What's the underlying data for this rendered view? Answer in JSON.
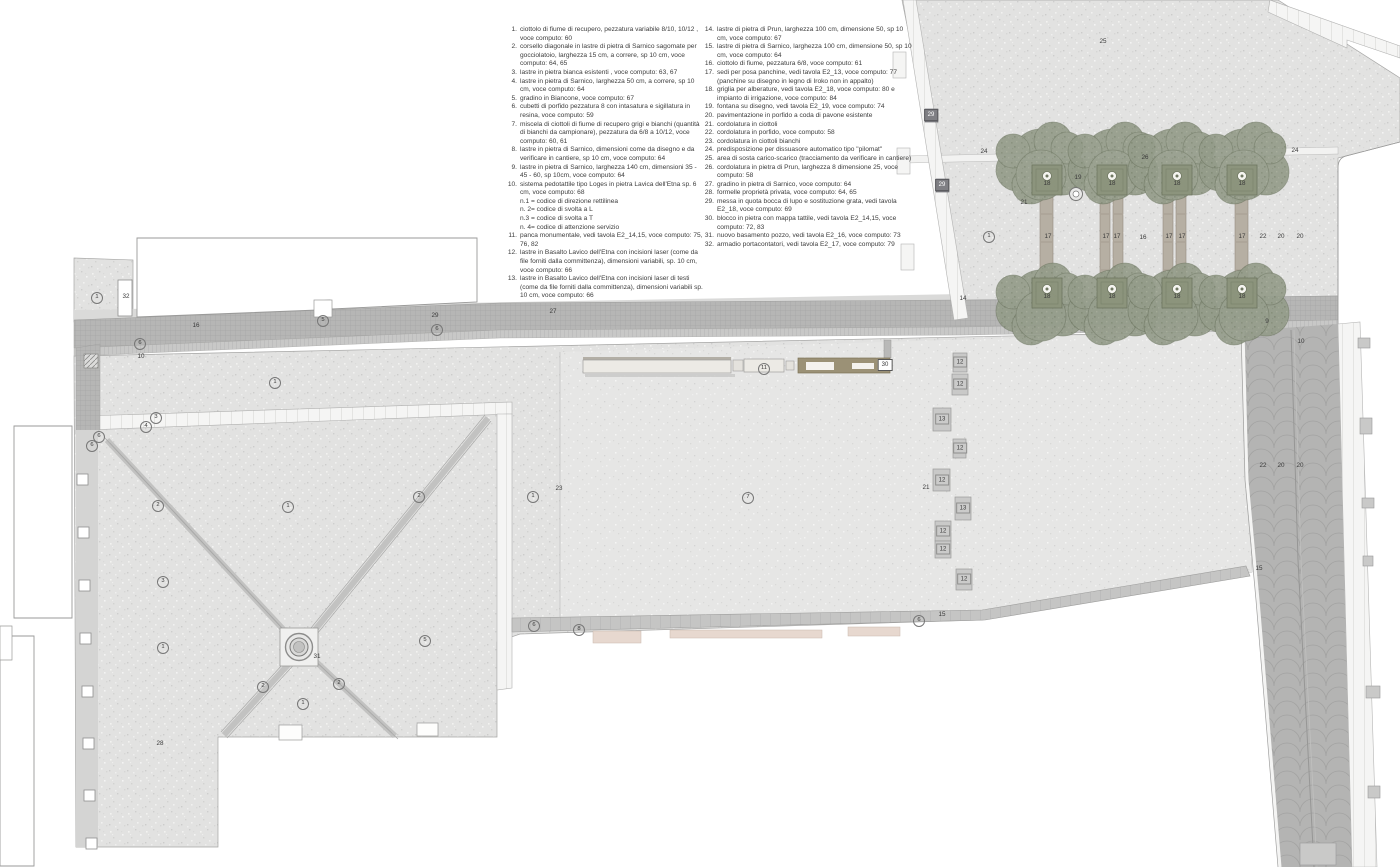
{
  "colors": {
    "paving": "#e2e2e1",
    "paving_light": "#e6e6e5",
    "road_cubetti": "#b6b6b5",
    "porphyry_street": "#b4b4b3",
    "white_slab": "#f5f5f4",
    "tree_canopy": "#949c8a",
    "bench": "#eceae5",
    "tactile_block": "#9b9176",
    "step_pink": "#e7d8cf"
  },
  "legend": {
    "col1": [
      {
        "n": "1.",
        "t": "ciottolo di fiume di recupero, pezzatura variabile 8/10, 10/12 , voce computo: 60"
      },
      {
        "n": "2.",
        "t": "corsello diagonale in lastre di pietra di Sarnico sagomate per gocciolatoio, larghezza 15 cm, a correre, sp 10 cm, voce computo: 64, 65"
      },
      {
        "n": "3.",
        "t": "lastre in pietra bianca esistenti , voce computo: 63, 67"
      },
      {
        "n": "4.",
        "t": "lastre in pietra di Sarnico, larghezza 50 cm, a correre, sp 10 cm, voce computo: 64"
      },
      {
        "n": "5.",
        "t": "gradino in Biancone, voce computo: 67"
      },
      {
        "n": "6.",
        "t": "cubetti di porfido pezzatura 8 con intasatura e sigillatura in resina, voce computo: 59"
      },
      {
        "n": "7.",
        "t": "miscela di ciottoli di fiume di recupero grigi e bianchi (quantità di bianchi da campionare), pezzatura da 6/8 a 10/12, voce computo: 60, 61"
      },
      {
        "n": "8.",
        "t": "lastre in pietra di Sarnico, dimensioni come da disegno e da verificare in cantiere, sp 10 cm, voce computo: 64"
      },
      {
        "n": "9.",
        "t": "lastre in pietra di Sarnico, larghezza 140 cm, dimensioni 35 - 45 - 60, sp 10cm, voce computo: 64"
      },
      {
        "n": "10.",
        "t": "sistema pedotattile tipo Loges in pietra Lavica dell'Etna sp. 6 cm, voce computo: 68"
      },
      {
        "n": "",
        "t": "n.1 = codice di direzione rettilinea"
      },
      {
        "n": "",
        "t": "n. 2= codice di svolta a L"
      },
      {
        "n": "",
        "t": "n.3 = codice di svolta a T"
      },
      {
        "n": "",
        "t": "n. 4= codice di attenzione servizio"
      },
      {
        "n": "11.",
        "t": "panca monumentale, vedi tavola E2_14,15, voce computo: 75, 76, 82"
      },
      {
        "n": "12.",
        "t": "lastre in Basalto Lavico dell'Etna con incisioni laser (come da file forniti dalla committenza), dimensioni variabili, sp. 10 cm, voce computo: 66"
      },
      {
        "n": "13.",
        "t": "lastre in Basalto Lavico dell'Etna con incisioni laser di testi (come da file forniti dalla committenza), dimensioni variabili sp. 10 cm, voce computo: 66"
      }
    ],
    "col2": [
      {
        "n": "14.",
        "t": "lastre di pietra di Prun, larghezza 100 cm, dimensione 50, sp 10 cm, voce computo: 67"
      },
      {
        "n": "15.",
        "t": "lastre di pietra di Sarnico, larghezza 100 cm, dimensione 50, sp 10 cm, voce computo: 64"
      },
      {
        "n": "16.",
        "t": "ciottolo di fiume, pezzatura 6/8, voce computo: 61"
      },
      {
        "n": "17.",
        "t": "sedi per posa panchine, vedi tavola E2_13, voce computo: 77 (panchine su disegno in legno di Iroko non in appalto)"
      },
      {
        "n": "18.",
        "t": "griglia per alberature, vedi tavola E2_18, voce computo: 80 e impianto di irrigazione, voce computo: 84"
      },
      {
        "n": "19.",
        "t": "fontana su disegno, vedi tavola E2_19, voce computo: 74"
      },
      {
        "n": "20.",
        "t": "pavimentazione in porfido a coda di pavone esistente"
      },
      {
        "n": "21.",
        "t": "cordolatura in ciottoli"
      },
      {
        "n": "22.",
        "t": "cordolatura in porfido, voce computo: 58"
      },
      {
        "n": "23.",
        "t": "cordolatura in ciottoli bianchi"
      },
      {
        "n": "24.",
        "t": "predisposizione per dissuasore automatico tipo \"pilomat\""
      },
      {
        "n": "25.",
        "t": "area di sosta carico-scarico (tracciamento da verificare in cantiere)"
      },
      {
        "n": "26.",
        "t": "cordolatura in pietra di Prun, larghezza 8 dimensione 25, voce computo: 58"
      },
      {
        "n": "27.",
        "t": "gradino in pietra di Sarnico, voce computo: 64"
      },
      {
        "n": "28.",
        "t": "formelle proprietà privata, voce computo: 64, 65"
      },
      {
        "n": "29.",
        "t": "messa in quota bocca di lupo e sostituzione grata, vedi tavola E2_18, voce computo: 69"
      },
      {
        "n": "30.",
        "t": "blocco in pietra con mappa tattile, vedi tavola E2_14,15, voce computo: 72, 83"
      },
      {
        "n": "31.",
        "t": "nuovo basamento pozzo, vedi tavola E2_16, voce computo: 73"
      },
      {
        "n": "32.",
        "t": "armadio portacontatori, vedi tavola E2_17, voce computo: 79"
      }
    ]
  },
  "plan": {
    "annotations": [
      {
        "n": "1",
        "x": 97,
        "y": 298,
        "k": "c"
      },
      {
        "n": "32",
        "x": 126,
        "y": 297,
        "k": "p"
      },
      {
        "n": "16",
        "x": 196,
        "y": 326,
        "k": "p"
      },
      {
        "n": "6",
        "x": 140,
        "y": 344,
        "k": "c"
      },
      {
        "n": "10",
        "x": 141,
        "y": 357,
        "k": "p"
      },
      {
        "n": "5",
        "x": 323,
        "y": 321,
        "k": "c"
      },
      {
        "n": "29",
        "x": 435,
        "y": 316,
        "k": "p"
      },
      {
        "n": "6",
        "x": 437,
        "y": 330,
        "k": "c"
      },
      {
        "n": "27",
        "x": 553,
        "y": 312,
        "k": "p"
      },
      {
        "n": "1",
        "x": 275,
        "y": 383,
        "k": "c"
      },
      {
        "n": "3",
        "x": 156,
        "y": 418,
        "k": "c"
      },
      {
        "n": "4",
        "x": 146,
        "y": 427,
        "k": "c"
      },
      {
        "n": "6",
        "x": 99,
        "y": 437,
        "k": "c"
      },
      {
        "n": "6",
        "x": 92,
        "y": 446,
        "k": "c"
      },
      {
        "n": "2",
        "x": 158,
        "y": 506,
        "k": "c"
      },
      {
        "n": "1",
        "x": 288,
        "y": 507,
        "k": "c"
      },
      {
        "n": "2",
        "x": 419,
        "y": 497,
        "k": "c"
      },
      {
        "n": "3",
        "x": 163,
        "y": 582,
        "k": "c"
      },
      {
        "n": "1",
        "x": 163,
        "y": 648,
        "k": "c"
      },
      {
        "n": "5",
        "x": 425,
        "y": 641,
        "k": "c"
      },
      {
        "n": "31",
        "x": 317,
        "y": 657,
        "k": "p"
      },
      {
        "n": "2",
        "x": 263,
        "y": 687,
        "k": "c"
      },
      {
        "n": "2",
        "x": 339,
        "y": 684,
        "k": "c"
      },
      {
        "n": "1",
        "x": 303,
        "y": 704,
        "k": "c"
      },
      {
        "n": "28",
        "x": 160,
        "y": 744,
        "k": "p"
      },
      {
        "n": "23",
        "x": 559,
        "y": 489,
        "k": "p"
      },
      {
        "n": "1",
        "x": 533,
        "y": 497,
        "k": "c"
      },
      {
        "n": "7",
        "x": 748,
        "y": 498,
        "k": "c"
      },
      {
        "n": "6",
        "x": 534,
        "y": 626,
        "k": "c"
      },
      {
        "n": "8",
        "x": 579,
        "y": 630,
        "k": "c"
      },
      {
        "n": "6",
        "x": 919,
        "y": 621,
        "k": "c"
      },
      {
        "n": "15",
        "x": 942,
        "y": 615,
        "k": "p"
      },
      {
        "n": "11",
        "x": 764,
        "y": 369,
        "k": "c"
      },
      {
        "n": "30",
        "x": 885,
        "y": 365,
        "k": "w"
      },
      {
        "n": "12",
        "x": 960,
        "y": 362,
        "k": "s"
      },
      {
        "n": "12",
        "x": 960,
        "y": 384,
        "k": "s"
      },
      {
        "n": "13",
        "x": 942,
        "y": 419,
        "k": "s"
      },
      {
        "n": "12",
        "x": 960,
        "y": 448,
        "k": "s"
      },
      {
        "n": "12",
        "x": 942,
        "y": 480,
        "k": "s"
      },
      {
        "n": "21",
        "x": 926,
        "y": 488,
        "k": "p"
      },
      {
        "n": "13",
        "x": 963,
        "y": 508,
        "k": "s"
      },
      {
        "n": "12",
        "x": 943,
        "y": 531,
        "k": "s"
      },
      {
        "n": "12",
        "x": 943,
        "y": 549,
        "k": "s"
      },
      {
        "n": "12",
        "x": 964,
        "y": 579,
        "k": "s"
      },
      {
        "n": "15",
        "x": 1259,
        "y": 569,
        "k": "p"
      },
      {
        "n": "22",
        "x": 1263,
        "y": 466,
        "k": "p"
      },
      {
        "n": "20",
        "x": 1281,
        "y": 466,
        "k": "p"
      },
      {
        "n": "20",
        "x": 1300,
        "y": 466,
        "k": "p"
      },
      {
        "n": "25",
        "x": 1103,
        "y": 42,
        "k": "p"
      },
      {
        "n": "29",
        "x": 931,
        "y": 115,
        "k": "d"
      },
      {
        "n": "24",
        "x": 984,
        "y": 152,
        "k": "p"
      },
      {
        "n": "26",
        "x": 1145,
        "y": 158,
        "k": "p"
      },
      {
        "n": "24",
        "x": 1295,
        "y": 151,
        "k": "p"
      },
      {
        "n": "29",
        "x": 942,
        "y": 185,
        "k": "d"
      },
      {
        "n": "21",
        "x": 1024,
        "y": 203,
        "k": "p"
      },
      {
        "n": "19",
        "x": 1078,
        "y": 178,
        "k": "p"
      },
      {
        "n": "1",
        "x": 989,
        "y": 237,
        "k": "c"
      },
      {
        "n": "17",
        "x": 1048,
        "y": 237,
        "k": "p"
      },
      {
        "n": "17",
        "x": 1106,
        "y": 237,
        "k": "p"
      },
      {
        "n": "17",
        "x": 1117,
        "y": 237,
        "k": "p"
      },
      {
        "n": "16",
        "x": 1143,
        "y": 238,
        "k": "p"
      },
      {
        "n": "17",
        "x": 1169,
        "y": 237,
        "k": "p"
      },
      {
        "n": "17",
        "x": 1182,
        "y": 237,
        "k": "p"
      },
      {
        "n": "17",
        "x": 1242,
        "y": 237,
        "k": "p"
      },
      {
        "n": "22",
        "x": 1263,
        "y": 237,
        "k": "p"
      },
      {
        "n": "20",
        "x": 1281,
        "y": 237,
        "k": "p"
      },
      {
        "n": "20",
        "x": 1300,
        "y": 237,
        "k": "p"
      },
      {
        "n": "18",
        "x": 1047,
        "y": 184,
        "k": "p"
      },
      {
        "n": "18",
        "x": 1112,
        "y": 184,
        "k": "p"
      },
      {
        "n": "18",
        "x": 1177,
        "y": 184,
        "k": "p"
      },
      {
        "n": "18",
        "x": 1242,
        "y": 184,
        "k": "p"
      },
      {
        "n": "18",
        "x": 1047,
        "y": 297,
        "k": "p"
      },
      {
        "n": "18",
        "x": 1112,
        "y": 297,
        "k": "p"
      },
      {
        "n": "18",
        "x": 1177,
        "y": 297,
        "k": "p"
      },
      {
        "n": "18",
        "x": 1242,
        "y": 297,
        "k": "p"
      },
      {
        "n": "14",
        "x": 963,
        "y": 299,
        "k": "p"
      },
      {
        "n": "9",
        "x": 1267,
        "y": 322,
        "k": "p"
      },
      {
        "n": "10",
        "x": 1301,
        "y": 342,
        "k": "p"
      }
    ],
    "trees": {
      "top_row_y": 166,
      "bottom_row_y": 301,
      "xs": [
        1044,
        1110,
        1176,
        1241
      ],
      "grille_top_y": 180,
      "grille_bottom_y": 293
    },
    "bench_strips": [
      {
        "x": 1040,
        "y": 196,
        "w": 13,
        "h": 92
      },
      {
        "x": 1100,
        "y": 196,
        "w": 10,
        "h": 92
      },
      {
        "x": 1113,
        "y": 196,
        "w": 10,
        "h": 92
      },
      {
        "x": 1163,
        "y": 196,
        "w": 10,
        "h": 92
      },
      {
        "x": 1176,
        "y": 196,
        "w": 10,
        "h": 92
      },
      {
        "x": 1235,
        "y": 196,
        "w": 13,
        "h": 92
      }
    ],
    "laser_slabs": [
      {
        "x": 953,
        "y": 353,
        "w": 14,
        "h": 19
      },
      {
        "x": 952,
        "y": 374,
        "w": 16,
        "h": 21
      },
      {
        "x": 933,
        "y": 408,
        "w": 18,
        "h": 23
      },
      {
        "x": 953,
        "y": 439,
        "w": 13,
        "h": 19
      },
      {
        "x": 933,
        "y": 469,
        "w": 17,
        "h": 22
      },
      {
        "x": 955,
        "y": 497,
        "w": 16,
        "h": 23
      },
      {
        "x": 935,
        "y": 521,
        "w": 16,
        "h": 20
      },
      {
        "x": 935,
        "y": 541,
        "w": 16,
        "h": 17
      },
      {
        "x": 956,
        "y": 569,
        "w": 16,
        "h": 21
      }
    ],
    "formelle": [
      {
        "x": 77,
        "y": 474
      },
      {
        "x": 78,
        "y": 527
      },
      {
        "x": 79,
        "y": 580
      },
      {
        "x": 80,
        "y": 633
      },
      {
        "x": 82,
        "y": 686
      },
      {
        "x": 83,
        "y": 738
      },
      {
        "x": 84,
        "y": 790
      },
      {
        "x": 86,
        "y": 838
      }
    ],
    "steps_pink": [
      {
        "x": 593,
        "y": 631,
        "w": 48,
        "h": 12
      },
      {
        "x": 670,
        "y": 630,
        "w": 152,
        "h": 8
      },
      {
        "x": 848,
        "y": 627,
        "w": 52,
        "h": 9
      }
    ],
    "building_stubs": [
      {
        "x": 1358,
        "y": 338,
        "w": 12,
        "h": 10
      },
      {
        "x": 1360,
        "y": 418,
        "w": 12,
        "h": 16
      },
      {
        "x": 1362,
        "y": 498,
        "w": 12,
        "h": 10
      },
      {
        "x": 1363,
        "y": 556,
        "w": 10,
        "h": 10
      },
      {
        "x": 1366,
        "y": 686,
        "w": 14,
        "h": 12
      },
      {
        "x": 1368,
        "y": 786,
        "w": 12,
        "h": 12
      },
      {
        "x": 1300,
        "y": 843,
        "w": 36,
        "h": 22
      }
    ]
  }
}
